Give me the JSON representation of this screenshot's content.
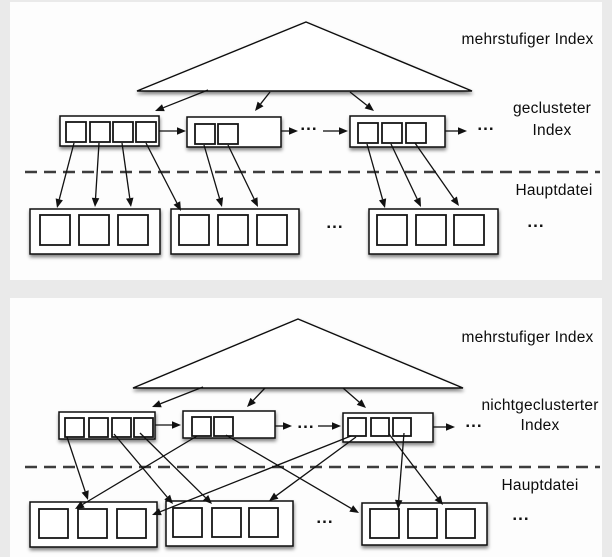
{
  "labels": {
    "top_level": "mehrstufiger Index",
    "top_index_line1": "geclusteter",
    "top_index_line2": "Index",
    "top_main": "Hauptdatei",
    "bottom_level": "mehrstufiger Index",
    "bottom_index_line1": "nichtgeclusterter",
    "bottom_index_line2": "Index",
    "bottom_main": "Hauptdatei",
    "ellipsis": "..."
  },
  "colors": {
    "page_background": "#eaeaea",
    "panel_background": "#fdfdfd",
    "line": "#111111",
    "dash": "#3d3d3d"
  },
  "diagram": {
    "stroke": "#111111",
    "dash_color": "#3d3d3d",
    "panels": [
      {
        "id": "clustered-index",
        "triangle": {
          "apex": [
            306,
            22
          ],
          "base_y": 91,
          "x1": 137,
          "x2": 472
        },
        "tri_arrows": [
          [
            208,
            90,
            155,
            111
          ],
          [
            270,
            92,
            255,
            111
          ],
          [
            350,
            92,
            374,
            111
          ]
        ],
        "index_blocks": [
          {
            "rect": [
              60,
              116,
              99,
              30
            ],
            "cell_size": 20,
            "cells": [
              [
                66,
                122
              ],
              [
                90,
                122
              ],
              [
                113,
                122
              ],
              [
                136,
                122
              ]
            ]
          },
          {
            "rect": [
              187,
              117,
              94,
              30
            ],
            "cell_size": 20,
            "cells": [
              [
                195,
                124
              ],
              [
                218,
                124
              ]
            ]
          },
          {
            "rect": [
              350,
              116,
              95,
              31
            ],
            "cell_size": 20,
            "cells": [
              [
                358,
                123
              ],
              [
                382,
                123
              ],
              [
                406,
                123
              ]
            ]
          }
        ],
        "chain_arrows": [
          [
            159,
            131,
            186,
            131
          ],
          [
            281,
            131,
            298,
            131
          ],
          [
            323,
            131,
            348,
            131
          ],
          [
            445,
            131,
            467,
            131
          ]
        ],
        "dashed_y": 172,
        "dashed_x": [
          25,
          600
        ],
        "main_blocks": [
          {
            "rect": [
              30,
              209,
              130,
              45
            ],
            "cell_size": 30,
            "cells": [
              [
                40,
                215
              ],
              [
                79,
                215
              ],
              [
                118,
                215
              ]
            ]
          },
          {
            "rect": [
              171,
              209,
              128,
              45
            ],
            "cell_size": 30,
            "cells": [
              [
                179,
                215
              ],
              [
                218,
                215
              ],
              [
                257,
                215
              ]
            ]
          },
          {
            "rect": [
              369,
              209,
              129,
              45
            ],
            "cell_size": 30,
            "cells": [
              [
                377,
                215
              ],
              [
                416,
                215
              ],
              [
                454,
                215
              ]
            ]
          }
        ],
        "ref_arrows": [
          [
            74,
            143,
            57,
            208
          ],
          [
            99,
            143,
            95,
            207
          ],
          [
            122,
            143,
            131,
            207
          ],
          [
            146,
            143,
            181,
            211
          ],
          [
            204,
            145,
            222,
            207
          ],
          [
            228,
            145,
            258,
            207
          ],
          [
            367,
            144,
            385,
            208
          ],
          [
            391,
            144,
            421,
            207
          ],
          [
            415,
            143,
            459,
            206
          ]
        ]
      },
      {
        "id": "nonclustered-index",
        "triangle": {
          "apex": [
            298,
            319
          ],
          "base_y": 388,
          "x1": 133,
          "x2": 463
        },
        "tri_arrows": [
          [
            203,
            387,
            152,
            407
          ],
          [
            265,
            388,
            247,
            407
          ],
          [
            343,
            388,
            366,
            408
          ]
        ],
        "index_blocks": [
          {
            "rect": [
              59,
              412,
              96,
              27
            ],
            "cell_size": 19,
            "cells": [
              [
                65,
                418
              ],
              [
                89,
                418
              ],
              [
                112,
                418
              ],
              [
                134,
                418
              ]
            ]
          },
          {
            "rect": [
              183,
              411,
              92,
              27
            ],
            "cell_size": 19,
            "cells": [
              [
                192,
                417
              ],
              [
                214,
                417
              ]
            ]
          },
          {
            "rect": [
              343,
              413,
              90,
              29
            ],
            "cell_size": 18,
            "cells": [
              [
                348,
                418
              ],
              [
                371,
                418
              ],
              [
                393,
                418
              ]
            ]
          }
        ],
        "chain_arrows": [
          [
            155,
            425,
            181,
            425
          ],
          [
            275,
            426,
            292,
            426
          ],
          [
            318,
            426,
            341,
            426
          ],
          [
            433,
            427,
            455,
            427
          ]
        ],
        "dashed_y": 467,
        "dashed_x": [
          25,
          600
        ],
        "main_blocks": [
          {
            "rect": [
              30,
              502,
              127,
              45
            ],
            "cell_size": 29,
            "cells": [
              [
                39,
                509
              ],
              [
                78,
                509
              ],
              [
                117,
                509
              ]
            ]
          },
          {
            "rect": [
              166,
              501,
              127,
              45
            ],
            "cell_size": 29,
            "cells": [
              [
                173,
                508
              ],
              [
                212,
                508
              ],
              [
                249,
                508
              ]
            ]
          },
          {
            "rect": [
              362,
              503,
              125,
              42
            ],
            "cell_size": 29,
            "cells": [
              [
                370,
                509
              ],
              [
                408,
                509
              ],
              [
                446,
                509
              ]
            ]
          }
        ],
        "ref_arrows": [
          [
            67,
            437,
            88,
            500
          ],
          [
            114,
            434,
            173,
            504
          ],
          [
            140,
            433,
            212,
            504
          ],
          [
            197,
            436,
            75,
            509
          ],
          [
            226,
            435,
            359,
            513
          ],
          [
            351,
            436,
            152,
            515
          ],
          [
            356,
            437,
            269,
            501
          ],
          [
            389,
            434,
            443,
            505
          ],
          [
            404,
            433,
            398,
            509
          ]
        ]
      }
    ]
  }
}
